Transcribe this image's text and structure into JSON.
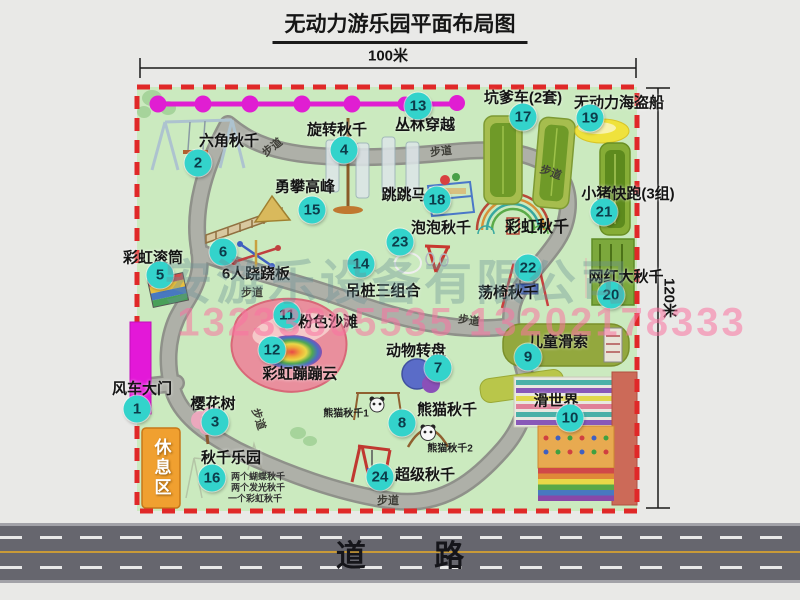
{
  "title": "无动力游乐园平面布局图",
  "dims": {
    "top": "100米",
    "right": "120米"
  },
  "road_label": "道 路",
  "watermark": {
    "company": "安游乐设备有限公司",
    "phone": "13233805535 13202178333"
  },
  "map": {
    "items": [
      {
        "num": 1,
        "label": "风车大门",
        "cx": 137,
        "cy": 409,
        "lx": 142,
        "ly": 388
      },
      {
        "num": 2,
        "label": "六角秋千",
        "cx": 198,
        "cy": 163,
        "lx": 229,
        "ly": 140
      },
      {
        "num": 3,
        "label": "樱花树",
        "cx": 215,
        "cy": 422,
        "lx": 213,
        "ly": 403
      },
      {
        "num": 4,
        "label": "旋转秋千",
        "cx": 344,
        "cy": 150,
        "lx": 337,
        "ly": 129
      },
      {
        "num": 5,
        "label": "彩虹滚筒",
        "cx": 160,
        "cy": 275,
        "lx": 153,
        "ly": 257
      },
      {
        "num": 6,
        "label": "6人跷跷板",
        "cx": 223,
        "cy": 252,
        "lx": 256,
        "ly": 273
      },
      {
        "num": 7,
        "label": "动物转盘",
        "cx": 438,
        "cy": 368,
        "lx": 416,
        "ly": 350
      },
      {
        "num": 8,
        "label": "熊猫秋千",
        "cx": 402,
        "cy": 423,
        "lx": 447,
        "ly": 409
      },
      {
        "num": 9,
        "label": "儿童滑索",
        "cx": 528,
        "cy": 357,
        "lx": 558,
        "ly": 341
      },
      {
        "num": 10,
        "label": "滑世界",
        "cx": 570,
        "cy": 418,
        "lx": 556,
        "ly": 400
      },
      {
        "num": 11,
        "label": "粉色沙滩",
        "cx": 287,
        "cy": 315,
        "lx": 328,
        "ly": 321
      },
      {
        "num": 12,
        "label": "彩虹蹦蹦云",
        "cx": 272,
        "cy": 350,
        "lx": 300,
        "ly": 373
      },
      {
        "num": 13,
        "label": "丛林穿越",
        "cx": 418,
        "cy": 106,
        "lx": 425,
        "ly": 124
      },
      {
        "num": 14,
        "label": "吊桩三组合",
        "cx": 361,
        "cy": 264,
        "lx": 383,
        "ly": 290
      },
      {
        "num": 15,
        "label": "勇攀高峰",
        "cx": 312,
        "cy": 210,
        "lx": 305,
        "ly": 186
      },
      {
        "num": 16,
        "label": "秋千乐园",
        "cx": 212,
        "cy": 478,
        "lx": 231,
        "ly": 457
      },
      {
        "num": 17,
        "label": "坑爹车(2套)",
        "cx": 523,
        "cy": 117,
        "lx": 523,
        "ly": 97
      },
      {
        "num": 18,
        "label": "跳跳马",
        "cx": 437,
        "cy": 200,
        "lx": 404,
        "ly": 194
      },
      {
        "num": 19,
        "label": "无动力海盗船",
        "cx": 590,
        "cy": 118,
        "lx": 619,
        "ly": 102
      },
      {
        "num": 20,
        "label": "网红大秋千",
        "cx": 611,
        "cy": 295,
        "lx": 626,
        "ly": 276
      },
      {
        "num": 21,
        "label": "小猪快跑(3组)",
        "cx": 604,
        "cy": 212,
        "lx": 628,
        "ly": 193
      },
      {
        "num": 22,
        "label": "荡椅秋千",
        "cx": 528,
        "cy": 268,
        "lx": 508,
        "ly": 292
      },
      {
        "num": 23,
        "label": "泡泡秋千",
        "cx": 400,
        "cy": 242,
        "lx": 441,
        "ly": 227
      },
      {
        "num": 24,
        "label": "超级秋千",
        "cx": 380,
        "cy": 477,
        "lx": 425,
        "ly": 474
      }
    ],
    "texts": [
      {
        "name": "rainbow-swing-label",
        "t": "彩虹秋千",
        "x": 537,
        "y": 225,
        "s": 16,
        "w": 700,
        "color": "#141414"
      },
      {
        "name": "panda-swing-1-label",
        "t": "熊猫秋千1",
        "x": 346,
        "y": 412,
        "s": 10,
        "w": 700,
        "color": "#222222"
      },
      {
        "name": "panda-swing-2-label",
        "t": "熊猫秋千2",
        "x": 450,
        "y": 447,
        "s": 10,
        "w": 700,
        "color": "#222222"
      },
      {
        "name": "swing-park-note-1",
        "t": "两个蝴蝶秋千",
        "x": 258,
        "y": 476,
        "s": 9,
        "w": 700,
        "color": "#333333"
      },
      {
        "name": "swing-park-note-2",
        "t": "两个发光秋千",
        "x": 258,
        "y": 487,
        "s": 9,
        "w": 700,
        "color": "#333333"
      },
      {
        "name": "swing-park-note-3",
        "t": "一个彩虹秋千",
        "x": 255,
        "y": 498,
        "s": 9,
        "w": 700,
        "color": "#333333"
      },
      {
        "name": "rest-area-label",
        "t": "休息区",
        "x": 161,
        "y": 468,
        "s": 17,
        "w": 700,
        "color": "#ffffff",
        "vertical": true
      },
      {
        "name": "path-label",
        "t": "步道",
        "x": 272,
        "y": 147,
        "s": 11,
        "r": -38
      },
      {
        "name": "path-label",
        "t": "步道",
        "x": 441,
        "y": 151,
        "s": 11,
        "r": -6
      },
      {
        "name": "path-label",
        "t": "步道",
        "x": 551,
        "y": 172,
        "s": 11,
        "r": 20
      },
      {
        "name": "path-label",
        "t": "步道",
        "x": 252,
        "y": 292,
        "s": 11
      },
      {
        "name": "path-label",
        "t": "步道",
        "x": 259,
        "y": 419,
        "s": 11,
        "r": 72
      },
      {
        "name": "path-label",
        "t": "步道",
        "x": 469,
        "y": 320,
        "s": 11,
        "r": 8
      },
      {
        "name": "path-label",
        "t": "步道",
        "x": 388,
        "y": 500,
        "s": 11
      }
    ]
  }
}
